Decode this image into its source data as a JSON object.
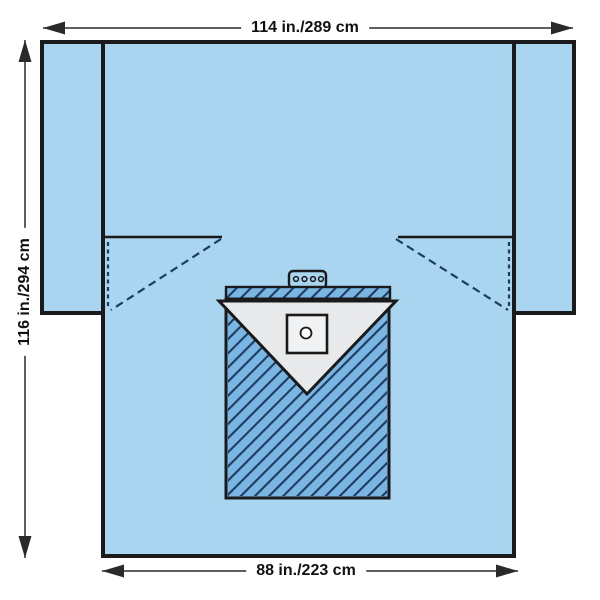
{
  "diagram": {
    "subject": "surgical-drape-dimensional-diagram"
  },
  "labels": {
    "top_width": "114 in./289 cm",
    "side_height": "116 in./294 cm",
    "bottom_width": "88 in./223 cm"
  },
  "colors": {
    "drape-blue": "#a9d5f0",
    "incise-blue": "#79b6e3",
    "hatch-line": "#1e3c5f",
    "outline": "#1a1a1a",
    "pouch-gray": "#e8e9ea",
    "square-gray": "#f1f2f3",
    "port-white": "#fbfcfd",
    "dim-line": "#2a2a2a",
    "label-text": "#111111",
    "page-bg": "#ffffff"
  }
}
